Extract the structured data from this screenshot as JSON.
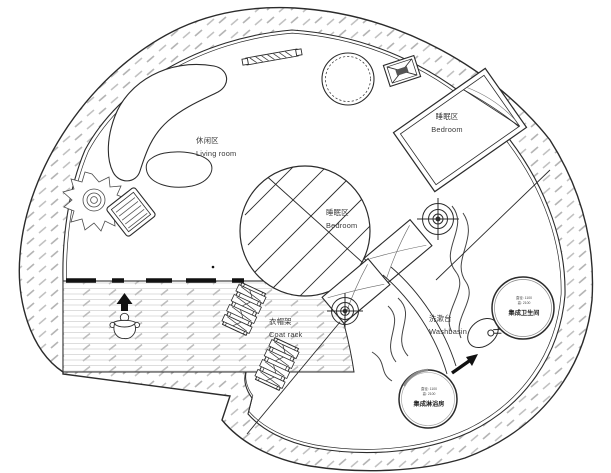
{
  "labels": {
    "living_room": {
      "zh": "休闲区",
      "en": "Living room"
    },
    "bedroom_upper": {
      "zh": "睡眠区",
      "en": "Bedroom"
    },
    "bedroom_center": {
      "zh": "睡眠区",
      "en": "Bedroom"
    },
    "coat_rack": {
      "zh": "衣帽架",
      "en": "Coat rack"
    },
    "washbasin": {
      "zh": "洗漱台",
      "en": "Washbasin"
    },
    "bathroom_pod": {
      "dim1": "直径: 1100",
      "dim2": "高: 2100",
      "label": "集成卫生间"
    },
    "shower_pod": {
      "dim1": "直径: 1100",
      "dim2": "高: 2100",
      "label": "集成淋浴房"
    }
  },
  "colors": {
    "line": "#2b2b2b",
    "wall_hatch": "#b5b5b5",
    "terrace_line": "#cccccc",
    "background": "#ffffff"
  }
}
